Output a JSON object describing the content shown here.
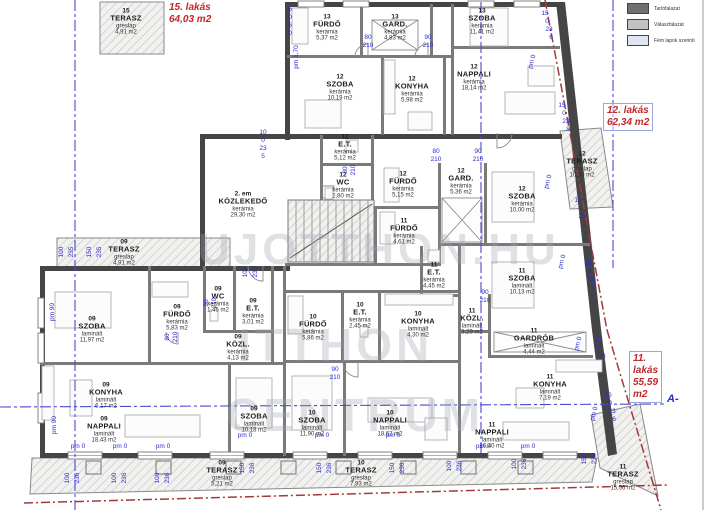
{
  "legend": {
    "items": [
      {
        "label": "Tartófalazat",
        "swatch": "#6f6f6f"
      },
      {
        "label": "Válaszfalazat",
        "swatch": "#c2c2c2"
      },
      {
        "label": "Fém lapok szerinti",
        "swatch": "#dfe5f0"
      }
    ]
  },
  "apartments": [
    {
      "id": "apartment-15",
      "lines": [
        "15. lakás",
        "64,03 m2"
      ],
      "x": 169,
      "y": 2,
      "boxed": false
    },
    {
      "id": "apartment-12",
      "lines": [
        "12. lakás",
        "62,34 m2"
      ],
      "x": 603,
      "y": 103,
      "boxed": true
    },
    {
      "id": "apartment-11",
      "lines": [
        "11.",
        "lakás",
        "55,59",
        "m2"
      ],
      "x": 629,
      "y": 351,
      "boxed": true
    }
  ],
  "section_marker": {
    "t": "A-",
    "x": 667,
    "y": 393
  },
  "watermark": [
    {
      "t": "UJOTTHON.HU",
      "x": 198,
      "y": 228,
      "size": 44
    },
    {
      "t": "ITTHON",
      "x": 238,
      "y": 322,
      "size": 46
    },
    {
      "t": "CENTRUM",
      "x": 226,
      "y": 392,
      "size": 46
    }
  ],
  "rooms": [
    {
      "u": "15",
      "n": "TERASZ",
      "m": "greslap",
      "a": "4,91 m2",
      "x": 126,
      "y": 22
    },
    {
      "u": "13",
      "n": "FÜRDŐ",
      "m": "kerámia",
      "a": "5,37 m2",
      "x": 327,
      "y": 28
    },
    {
      "u": "13",
      "n": "GARD.",
      "m": "kerámia",
      "a": "4,83 m2",
      "x": 395,
      "y": 28
    },
    {
      "u": "13",
      "n": "SZOBA",
      "m": "kerámia",
      "a": "11,41 m2",
      "x": 482,
      "y": 22
    },
    {
      "u": "12",
      "n": "SZOBA",
      "m": "kerámia",
      "a": "10,19 m2",
      "x": 340,
      "y": 88
    },
    {
      "u": "12",
      "n": "KONYHA",
      "m": "kerámia",
      "a": "5,98 m2",
      "x": 412,
      "y": 90
    },
    {
      "u": "12",
      "n": "NAPPALI",
      "m": "kerámia",
      "a": "18,14 m2",
      "x": 474,
      "y": 78
    },
    {
      "u": "12",
      "n": "E.T.",
      "m": "kerámia",
      "a": "5,12 m2",
      "x": 345,
      "y": 148
    },
    {
      "u": "12",
      "n": "WC",
      "m": "kerámia",
      "a": "2,80 m2",
      "x": 343,
      "y": 186
    },
    {
      "u": "12",
      "n": "FÜRDŐ",
      "m": "kerámia",
      "a": "5,15 m2",
      "x": 403,
      "y": 185
    },
    {
      "u": "12",
      "n": "GARD.",
      "m": "kerámia",
      "a": "5,36 m2",
      "x": 461,
      "y": 182
    },
    {
      "u": "12",
      "n": "SZOBA",
      "m": "kerámia",
      "a": "10,00 m2",
      "x": 522,
      "y": 200
    },
    {
      "u": "12",
      "n": "TERASZ",
      "m": "greslap",
      "a": "10,30 m2",
      "x": 582,
      "y": 165
    },
    {
      "u": "2. em",
      "n": "KÖZLEKEDŐ",
      "m": "kerámia",
      "a": "29,30 m2",
      "x": 243,
      "y": 205
    },
    {
      "u": "11",
      "n": "FÜRDŐ",
      "m": "kerámia",
      "a": "4,61 m2",
      "x": 404,
      "y": 232
    },
    {
      "u": "11",
      "n": "E.T.",
      "m": "kerámia",
      "a": "4,45 m2",
      "x": 434,
      "y": 276
    },
    {
      "u": "11",
      "n": "SZOBA",
      "m": "laminált",
      "a": "10,13 m2",
      "x": 522,
      "y": 282
    },
    {
      "u": "11",
      "n": "KÖZL.",
      "m": "laminált",
      "a": "3,29 m2",
      "x": 472,
      "y": 322
    },
    {
      "u": "11",
      "n": "GARDRÓB",
      "m": "laminált",
      "a": "4,44 m2",
      "x": 534,
      "y": 342
    },
    {
      "u": "11",
      "n": "KONYHA",
      "m": "laminált",
      "a": "7,19 m2",
      "x": 550,
      "y": 388
    },
    {
      "u": "11",
      "n": "NAPPALI",
      "m": "laminált",
      "a": "16,40 m2",
      "x": 492,
      "y": 436
    },
    {
      "u": "11",
      "n": "TERASZ",
      "m": "greslap",
      "a": "15,56 m2",
      "x": 623,
      "y": 478
    },
    {
      "u": "09",
      "n": "TERASZ",
      "m": "greslap",
      "a": "4,91 m2",
      "x": 124,
      "y": 253
    },
    {
      "u": "09",
      "n": "SZOBA",
      "m": "laminált",
      "a": "11,97 m2",
      "x": 92,
      "y": 330
    },
    {
      "u": "09",
      "n": "FÜRDŐ",
      "m": "kerámia",
      "a": "5,83 m2",
      "x": 177,
      "y": 318
    },
    {
      "u": "09",
      "n": "WC",
      "m": "kerámia",
      "a": "1,45 m2",
      "x": 218,
      "y": 300
    },
    {
      "u": "09",
      "n": "E.T.",
      "m": "kerámia",
      "a": "3,01 m2",
      "x": 253,
      "y": 312
    },
    {
      "u": "09",
      "n": "KÖZL.",
      "m": "kerámia",
      "a": "4,13 m2",
      "x": 238,
      "y": 348
    },
    {
      "u": "09",
      "n": "KONYHA",
      "m": "laminált",
      "a": "6,17 m2",
      "x": 106,
      "y": 396
    },
    {
      "u": "09",
      "n": "NAPPALI",
      "m": "laminált",
      "a": "18,43 m2",
      "x": 104,
      "y": 430
    },
    {
      "u": "09",
      "n": "SZOBA",
      "m": "laminált",
      "a": "10,18 m2",
      "x": 254,
      "y": 420
    },
    {
      "u": "09",
      "n": "TERASZ",
      "m": "greslap",
      "a": "5,21 m2",
      "x": 222,
      "y": 474
    },
    {
      "u": "10",
      "n": "FÜRDŐ",
      "m": "kerámia",
      "a": "5,86 m2",
      "x": 313,
      "y": 328
    },
    {
      "u": "10",
      "n": "E.T.",
      "m": "kerámia",
      "a": "2,45 m2",
      "x": 360,
      "y": 316
    },
    {
      "u": "10",
      "n": "KONYHA",
      "m": "laminált",
      "a": "4,30 m2",
      "x": 418,
      "y": 325
    },
    {
      "u": "10",
      "n": "SZOBA",
      "m": "laminált",
      "a": "11,90 m2",
      "x": 312,
      "y": 424
    },
    {
      "u": "10",
      "n": "NAPPALI",
      "m": "laminált",
      "a": "18,62 m2",
      "x": 390,
      "y": 424
    },
    {
      "u": "10",
      "n": "TERASZ",
      "m": "greslap",
      "a": "7,93 m2",
      "x": 361,
      "y": 474
    }
  ],
  "dims": [
    {
      "t": "80",
      "x": 368,
      "y": 38
    },
    {
      "t": "210",
      "x": 368,
      "y": 46
    },
    {
      "t": "90",
      "x": 428,
      "y": 38
    },
    {
      "t": "210",
      "x": 428,
      "y": 46
    },
    {
      "t": "90",
      "x": 478,
      "y": 152
    },
    {
      "t": "210",
      "x": 478,
      "y": 160
    },
    {
      "t": "80",
      "x": 436,
      "y": 152
    },
    {
      "t": "210",
      "x": 436,
      "y": 160
    },
    {
      "t": "90",
      "x": 335,
      "y": 370
    },
    {
      "t": "210",
      "x": 335,
      "y": 378
    },
    {
      "t": "90",
      "x": 485,
      "y": 293
    },
    {
      "t": "210",
      "x": 485,
      "y": 301
    },
    {
      "t": "pm 1,70",
      "x": 297,
      "y": 57,
      "r": -90
    },
    {
      "t": "pm 90",
      "x": 53,
      "y": 312,
      "r": -90
    },
    {
      "t": "pm 90",
      "x": 55,
      "y": 425,
      "r": -90
    },
    {
      "t": "pm 0",
      "x": 78,
      "y": 447
    },
    {
      "t": "pm 0",
      "x": 120,
      "y": 447
    },
    {
      "t": "pm 0",
      "x": 163,
      "y": 447
    },
    {
      "t": "pm 0",
      "x": 245,
      "y": 436
    },
    {
      "t": "pm 0",
      "x": 322,
      "y": 436
    },
    {
      "t": "pm 0",
      "x": 393,
      "y": 436
    },
    {
      "t": "pm 0",
      "x": 483,
      "y": 447
    },
    {
      "t": "pm 0",
      "x": 528,
      "y": 447
    },
    {
      "t": "pm 0",
      "x": 533,
      "y": 62,
      "r": -75
    },
    {
      "t": "pm 0",
      "x": 549,
      "y": 182,
      "r": -75
    },
    {
      "t": "pm 0",
      "x": 563,
      "y": 262,
      "r": -75
    },
    {
      "t": "pm 0",
      "x": 579,
      "y": 344,
      "r": -75
    },
    {
      "t": "pm 0",
      "x": 595,
      "y": 414,
      "r": -75
    },
    {
      "t": "100",
      "x": 62,
      "y": 252,
      "r": -90
    },
    {
      "t": "235",
      "x": 72,
      "y": 252,
      "r": -90
    },
    {
      "t": "150",
      "x": 90,
      "y": 252,
      "r": -90
    },
    {
      "t": "235",
      "x": 100,
      "y": 252,
      "r": -90
    },
    {
      "t": "100",
      "x": 246,
      "y": 272,
      "r": -90
    },
    {
      "t": "235",
      "x": 256,
      "y": 272,
      "r": -90
    },
    {
      "t": "80",
      "x": 346,
      "y": 170,
      "r": -90
    },
    {
      "t": "210",
      "x": 354,
      "y": 170,
      "r": -90
    },
    {
      "t": "80",
      "x": 168,
      "y": 337,
      "r": -90
    },
    {
      "t": "210",
      "x": 176,
      "y": 337,
      "r": -90
    },
    {
      "t": "90",
      "x": 207,
      "y": 303,
      "r": -90
    },
    {
      "t": "210",
      "x": 215,
      "y": 303,
      "r": -90
    },
    {
      "t": "10",
      "x": 263,
      "y": 133
    },
    {
      "t": "0",
      "x": 263,
      "y": 141
    },
    {
      "t": "23",
      "x": 263,
      "y": 149
    },
    {
      "t": "5",
      "x": 263,
      "y": 157
    },
    {
      "t": "6",
      "x": 290,
      "y": 10
    },
    {
      "t": "0",
      "x": 290,
      "y": 18
    },
    {
      "t": "6",
      "x": 290,
      "y": 26
    },
    {
      "t": "0",
      "x": 290,
      "y": 34
    },
    {
      "t": "15",
      "x": 545,
      "y": 14
    },
    {
      "t": "0",
      "x": 547,
      "y": 22
    },
    {
      "t": "23",
      "x": 549,
      "y": 30
    },
    {
      "t": "6",
      "x": 551,
      "y": 38
    },
    {
      "t": "15",
      "x": 562,
      "y": 106
    },
    {
      "t": "0",
      "x": 564,
      "y": 114
    },
    {
      "t": "23",
      "x": 566,
      "y": 122
    },
    {
      "t": "8",
      "x": 568,
      "y": 130
    },
    {
      "t": "15",
      "x": 578,
      "y": 201
    },
    {
      "t": "0",
      "x": 580,
      "y": 209
    },
    {
      "t": "23",
      "x": 582,
      "y": 217
    },
    {
      "t": "6",
      "x": 584,
      "y": 225
    },
    {
      "t": "15",
      "x": 588,
      "y": 264
    },
    {
      "t": "0",
      "x": 590,
      "y": 272
    },
    {
      "t": "23",
      "x": 592,
      "y": 280
    },
    {
      "t": "6",
      "x": 594,
      "y": 288
    },
    {
      "t": "10",
      "x": 598,
      "y": 341
    },
    {
      "t": "0",
      "x": 600,
      "y": 349
    },
    {
      "t": "23",
      "x": 602,
      "y": 357
    },
    {
      "t": "6",
      "x": 604,
      "y": 365
    },
    {
      "t": "10",
      "x": 608,
      "y": 396
    },
    {
      "t": "0",
      "x": 610,
      "y": 404
    },
    {
      "t": "23",
      "x": 612,
      "y": 412
    },
    {
      "t": "6",
      "x": 614,
      "y": 420
    },
    {
      "t": "100",
      "x": 68,
      "y": 478,
      "r": -90
    },
    {
      "t": "236",
      "x": 78,
      "y": 478,
      "r": -90
    },
    {
      "t": "100",
      "x": 115,
      "y": 478,
      "r": -90
    },
    {
      "t": "236",
      "x": 125,
      "y": 478,
      "r": -90
    },
    {
      "t": "100",
      "x": 158,
      "y": 478,
      "r": -90
    },
    {
      "t": "236",
      "x": 168,
      "y": 478,
      "r": -90
    },
    {
      "t": "150",
      "x": 243,
      "y": 468,
      "r": -90
    },
    {
      "t": "236",
      "x": 253,
      "y": 468,
      "r": -90
    },
    {
      "t": "150",
      "x": 320,
      "y": 468,
      "r": -90
    },
    {
      "t": "236",
      "x": 330,
      "y": 468,
      "r": -90
    },
    {
      "t": "150",
      "x": 393,
      "y": 468,
      "r": -90
    },
    {
      "t": "236",
      "x": 403,
      "y": 468,
      "r": -90
    },
    {
      "t": "100",
      "x": 450,
      "y": 466,
      "r": -90
    },
    {
      "t": "236",
      "x": 460,
      "y": 466,
      "r": -90
    },
    {
      "t": "100",
      "x": 515,
      "y": 464,
      "r": -90
    },
    {
      "t": "236",
      "x": 525,
      "y": 464,
      "r": -90
    },
    {
      "t": "150",
      "x": 585,
      "y": 459,
      "r": -90
    },
    {
      "t": "236",
      "x": 595,
      "y": 459,
      "r": -90
    }
  ]
}
